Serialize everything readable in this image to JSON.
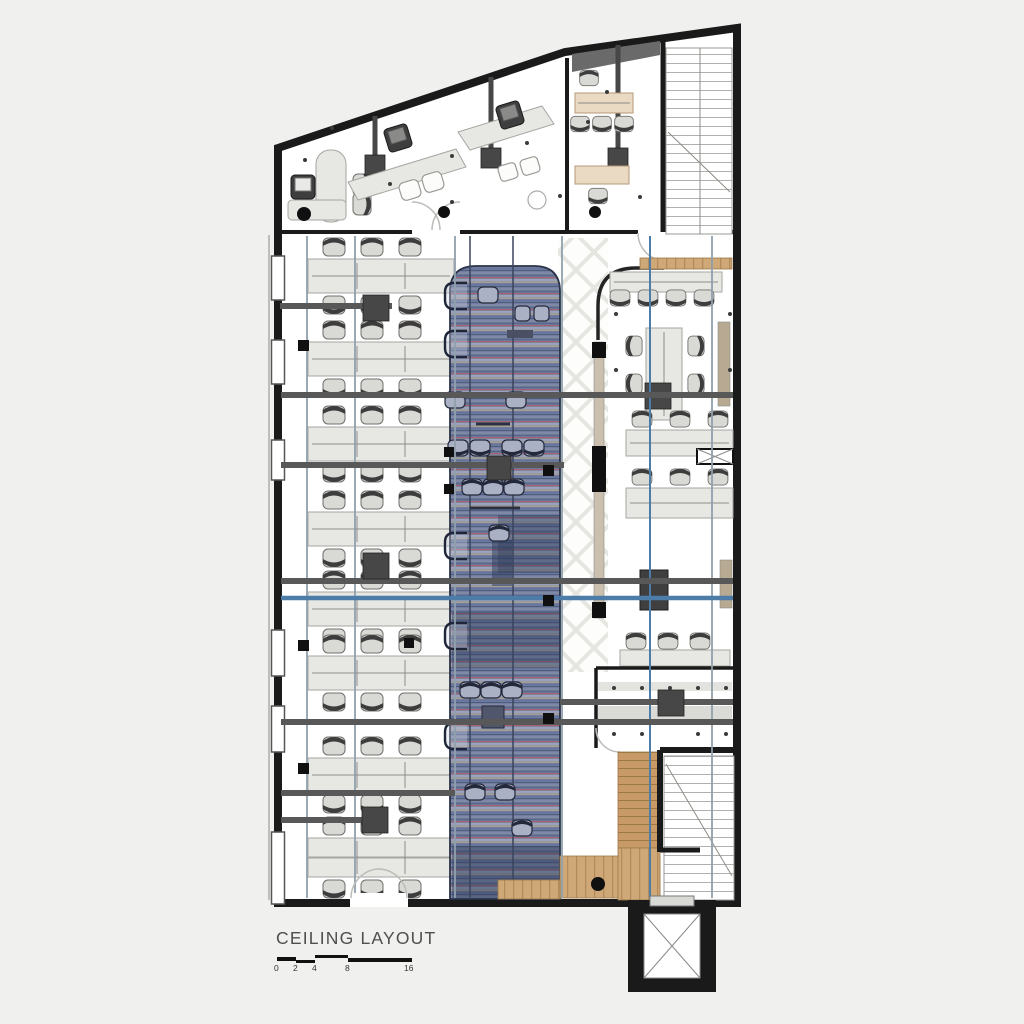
{
  "sheet": {
    "background": "#f0f0ee"
  },
  "title_block": {
    "title": "CEILING LAYOUT",
    "scale_bar": {
      "labels": [
        "0",
        "2",
        "4",
        "8",
        "16"
      ]
    }
  },
  "palette": {
    "sheet": "#f0f0ee",
    "wall": "#1a1a1a",
    "floor": "#ffffff",
    "desk": "#e7e7e3",
    "chair": "#d9d9d5",
    "chair_back": "#3d3d3d",
    "column": "#474747",
    "beam": "#585858",
    "beam_blue": "#4e7ca8",
    "track": "#90a0ad",
    "carpet_base": "#7f89a6",
    "carpet_stripe_red": "#a3616f",
    "carpet_stripe_navy": "#5a678c",
    "carpet_stripe_tan": "#b5a88e",
    "rug_dark": "#2e3a57",
    "wood": "#cfa878",
    "wood_grain": "#b58a5c",
    "lattice": "#e2e2dc",
    "partition_wood": "#cbbfae"
  }
}
